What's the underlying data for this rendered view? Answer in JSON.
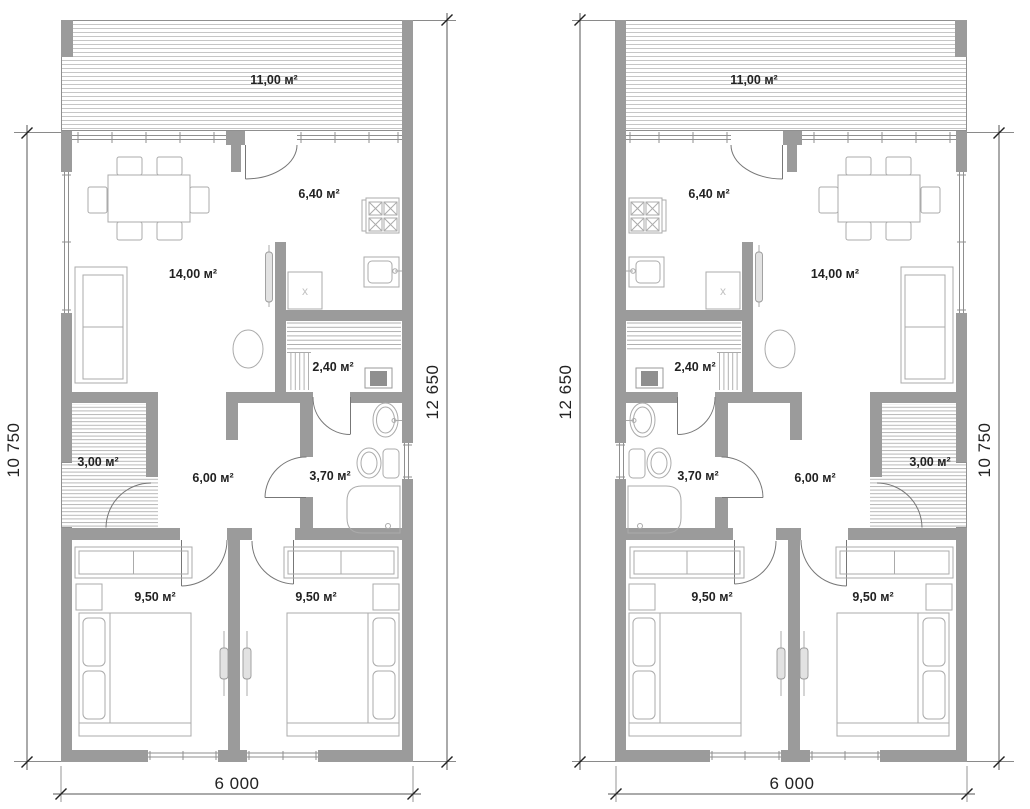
{
  "drawing": {
    "type": "architectural floor plan, two mirrored duplex units",
    "background": "#ffffff"
  },
  "labels": {
    "terrace": "11,00 м²",
    "kitchen": "6,40 м²",
    "living_room": "14,00 м²",
    "sauna": "2,40 м²",
    "porch": "3,00 м²",
    "hall": "6,00 м²",
    "bathroom": "3,70 м²",
    "bedroom": "9,50 м²",
    "washer_mark": "х"
  },
  "dimensions": {
    "overall_width": "6 000",
    "overall_depth": "12 650",
    "main_depth": "10 750"
  },
  "colors": {
    "wall": "#9b9b9b",
    "hatch_line": "#c6c6c6",
    "furniture_line": "#ababab",
    "door_line": "#777777",
    "dimension_line": "#555555",
    "text": "#222222"
  }
}
